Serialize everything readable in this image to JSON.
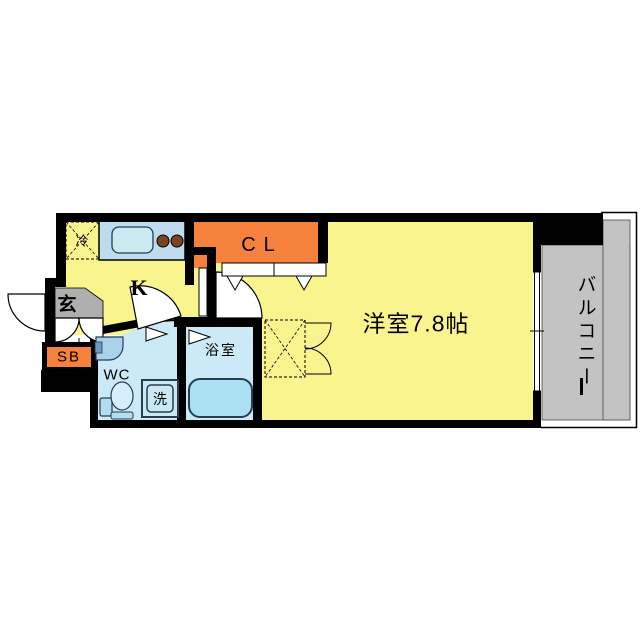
{
  "labels": {
    "refrigerator": "冷",
    "kitchen": "K",
    "entrance": "玄",
    "shoe_box": "SB",
    "toilet_room": "WC",
    "washer": "洗",
    "bathroom": "浴室",
    "closet": "CL",
    "main_room": "洋室7.8帖",
    "balcony": "バルコニー"
  },
  "colors": {
    "room_yellow": "#FAF48E",
    "closet_orange": "#F5813D",
    "entrance_gray": "#AFAFAF",
    "balcony_gray": "#C3C3C3",
    "wet_room_blue": "#CCE9F7",
    "counter_blue": "#BFDCEF",
    "sink_blue": "#C9EAF0",
    "tub_blue": "#ABDFF2",
    "fixture_blue": "#B5DDF1",
    "basin_blue": "#A9D2EB",
    "burner_brown": "#7A4523",
    "wall_black": "#000000"
  }
}
